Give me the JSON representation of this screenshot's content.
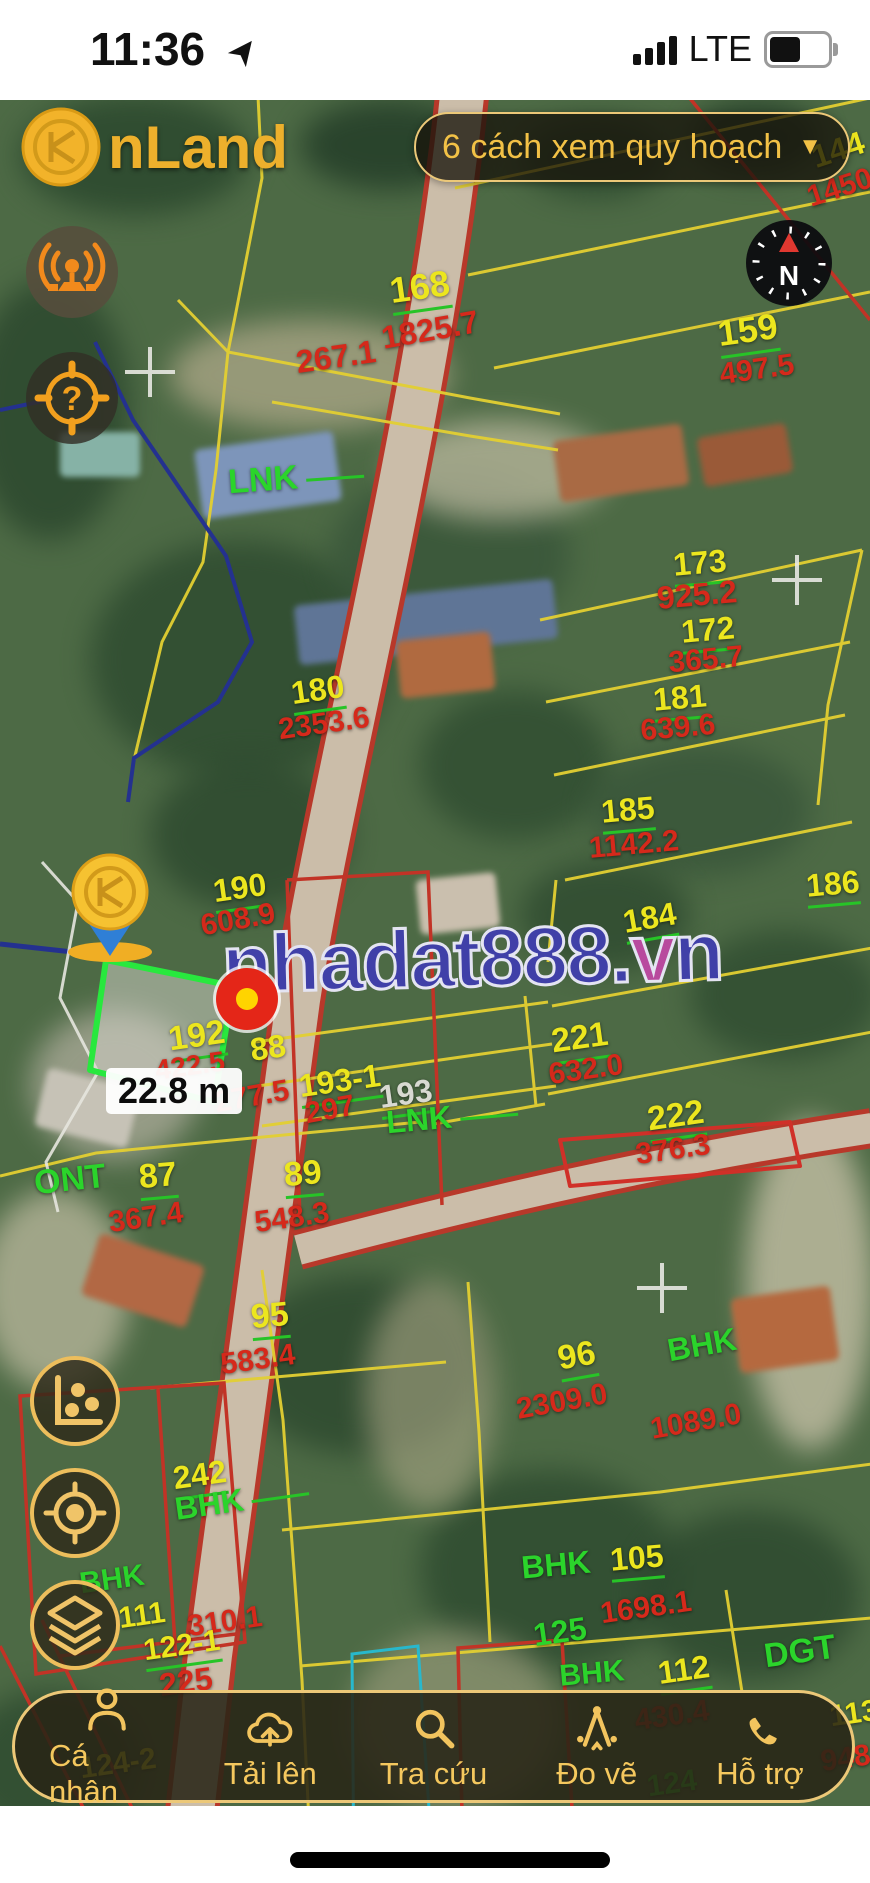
{
  "status_bar": {
    "time": "11:36",
    "network": "LTE"
  },
  "header": {
    "app_name": "nLand",
    "planning_selector": "6 cách xem quy hoạch",
    "dropdown_arrow": "▼"
  },
  "map_controls": {
    "compass_label": "N",
    "left_top_buttons": [
      "broadcast",
      "help-locate"
    ],
    "left_bottom_buttons": [
      "stats",
      "locate",
      "layers"
    ]
  },
  "map": {
    "watermark": "nhadat888.vn",
    "measurement_label": "22.8 m",
    "labels": [
      {
        "t": "168",
        "c": "num",
        "x": 420,
        "y": 289,
        "r": -8,
        "s": 36,
        "ul": 1
      },
      {
        "t": "1825.7",
        "c": "area",
        "x": 430,
        "y": 330,
        "r": -10,
        "s": 32
      },
      {
        "t": "159",
        "c": "num",
        "x": 748,
        "y": 332,
        "r": -8,
        "s": 36,
        "ul": 1
      },
      {
        "t": "497.5",
        "c": "area",
        "x": 757,
        "y": 370,
        "r": -8,
        "s": 30
      },
      {
        "t": "144",
        "c": "num",
        "x": 838,
        "y": 150,
        "r": -18,
        "s": 32
      },
      {
        "t": "1450",
        "c": "area",
        "x": 840,
        "y": 188,
        "r": -18,
        "s": 30
      },
      {
        "t": "267.1",
        "c": "area",
        "x": 336,
        "y": 357,
        "r": -8,
        "s": 32
      },
      {
        "t": "LNK",
        "c": "code",
        "x": 296,
        "y": 478,
        "r": -4,
        "s": 34,
        "line": 1
      },
      {
        "t": "173",
        "c": "num",
        "x": 700,
        "y": 565,
        "r": -5,
        "s": 32,
        "ul": 1
      },
      {
        "t": "925.2",
        "c": "area",
        "x": 697,
        "y": 595,
        "r": -5,
        "s": 32
      },
      {
        "t": "172",
        "c": "num",
        "x": 708,
        "y": 632,
        "r": -5,
        "s": 32,
        "ul": 1
      },
      {
        "t": "365.7",
        "c": "area",
        "x": 706,
        "y": 660,
        "r": -5,
        "s": 30
      },
      {
        "t": "180",
        "c": "num",
        "x": 318,
        "y": 692,
        "r": -8,
        "s": 32,
        "ul": 1
      },
      {
        "t": "2353.6",
        "c": "area",
        "x": 324,
        "y": 724,
        "r": -8,
        "s": 30
      },
      {
        "t": "181",
        "c": "num",
        "x": 680,
        "y": 700,
        "r": -5,
        "s": 32,
        "ul": 1
      },
      {
        "t": "639.6",
        "c": "area",
        "x": 678,
        "y": 728,
        "r": -5,
        "s": 30
      },
      {
        "t": "185",
        "c": "num",
        "x": 628,
        "y": 812,
        "r": -5,
        "s": 32,
        "ul": 1
      },
      {
        "t": "1142.2",
        "c": "area",
        "x": 634,
        "y": 845,
        "r": -5,
        "s": 30
      },
      {
        "t": "186",
        "c": "num",
        "x": 833,
        "y": 886,
        "r": -5,
        "s": 32,
        "ul": 1
      },
      {
        "t": "190",
        "c": "num",
        "x": 240,
        "y": 890,
        "r": -8,
        "s": 32,
        "ul": 1
      },
      {
        "t": "608.9",
        "c": "area",
        "x": 238,
        "y": 920,
        "r": -10,
        "s": 30
      },
      {
        "t": "184",
        "c": "num",
        "x": 650,
        "y": 920,
        "r": -10,
        "s": 32,
        "ul": 1
      },
      {
        "t": "192",
        "c": "num",
        "x": 197,
        "y": 1038,
        "r": -8,
        "s": 34,
        "ul": 1
      },
      {
        "t": "422.5",
        "c": "area",
        "x": 190,
        "y": 1066,
        "r": -8,
        "s": 28
      },
      {
        "t": "88",
        "c": "num",
        "x": 268,
        "y": 1048,
        "r": -8,
        "s": 32
      },
      {
        "t": "277.5",
        "c": "area",
        "x": 252,
        "y": 1097,
        "r": -10,
        "s": 30
      },
      {
        "t": "193-1",
        "c": "num",
        "x": 340,
        "y": 1083,
        "r": -8,
        "s": 32,
        "ul": 1
      },
      {
        "t": "297",
        "c": "area",
        "x": 330,
        "y": 1110,
        "r": -10,
        "s": 30
      },
      {
        "t": "193",
        "c": "plain",
        "x": 406,
        "y": 1096,
        "r": -8,
        "s": 32,
        "ul": 1
      },
      {
        "t": "LNK",
        "c": "code",
        "x": 452,
        "y": 1117,
        "r": -5,
        "s": 32,
        "line": 1
      },
      {
        "t": "221",
        "c": "num",
        "x": 580,
        "y": 1040,
        "r": -8,
        "s": 34,
        "ul": 1
      },
      {
        "t": "632.0",
        "c": "area",
        "x": 586,
        "y": 1070,
        "r": -8,
        "s": 30
      },
      {
        "t": "222",
        "c": "num",
        "x": 676,
        "y": 1118,
        "r": -8,
        "s": 34,
        "ul": 1
      },
      {
        "t": "376.3",
        "c": "area",
        "x": 673,
        "y": 1150,
        "r": -8,
        "s": 30
      },
      {
        "t": "ONT",
        "c": "code",
        "x": 70,
        "y": 1180,
        "r": -6,
        "s": 34
      },
      {
        "t": "87",
        "c": "num",
        "x": 158,
        "y": 1178,
        "r": -5,
        "s": 34,
        "ul": 1
      },
      {
        "t": "367.4",
        "c": "area",
        "x": 146,
        "y": 1218,
        "r": -8,
        "s": 30
      },
      {
        "t": "89",
        "c": "num",
        "x": 303,
        "y": 1176,
        "r": -5,
        "s": 34,
        "ul": 1
      },
      {
        "t": "548.3",
        "c": "area",
        "x": 292,
        "y": 1218,
        "r": -8,
        "s": 30
      },
      {
        "t": "95",
        "c": "num",
        "x": 270,
        "y": 1318,
        "r": -5,
        "s": 34,
        "ul": 1
      },
      {
        "t": "583.4",
        "c": "area",
        "x": 258,
        "y": 1360,
        "r": -8,
        "s": 30
      },
      {
        "t": "96",
        "c": "num",
        "x": 577,
        "y": 1358,
        "r": -10,
        "s": 34,
        "ul": 1
      },
      {
        "t": "2309.0",
        "c": "area",
        "x": 562,
        "y": 1402,
        "r": -10,
        "s": 30
      },
      {
        "t": "BHK",
        "c": "code",
        "x": 702,
        "y": 1345,
        "r": -10,
        "s": 32
      },
      {
        "t": "1089.0",
        "c": "area",
        "x": 696,
        "y": 1422,
        "r": -10,
        "s": 30
      },
      {
        "t": "242",
        "c": "num",
        "x": 200,
        "y": 1477,
        "r": -8,
        "s": 32,
        "ul": 1
      },
      {
        "t": "BHK",
        "c": "code",
        "x": 242,
        "y": 1500,
        "r": -8,
        "s": 32,
        "line": 1
      },
      {
        "t": "BHK",
        "c": "code",
        "x": 112,
        "y": 1580,
        "r": -8,
        "s": 30
      },
      {
        "t": "111",
        "c": "num",
        "x": 142,
        "y": 1616,
        "r": -8,
        "s": 30
      },
      {
        "t": "310.1",
        "c": "area",
        "x": 225,
        "y": 1622,
        "r": -8,
        "s": 30
      },
      {
        "t": "122-1",
        "c": "num",
        "x": 182,
        "y": 1648,
        "r": -8,
        "s": 30,
        "ul": 1
      },
      {
        "t": "225",
        "c": "area",
        "x": 186,
        "y": 1682,
        "r": -8,
        "s": 32
      },
      {
        "t": "BHK",
        "c": "code",
        "x": 556,
        "y": 1565,
        "r": -5,
        "s": 32
      },
      {
        "t": "105",
        "c": "num",
        "x": 637,
        "y": 1560,
        "r": -5,
        "s": 32,
        "ul": 1
      },
      {
        "t": "1698.1",
        "c": "area",
        "x": 646,
        "y": 1608,
        "r": -8,
        "s": 30
      },
      {
        "t": "125",
        "c": "code",
        "x": 560,
        "y": 1632,
        "r": -8,
        "s": 32
      },
      {
        "t": "DGT",
        "c": "code",
        "x": 800,
        "y": 1652,
        "r": -8,
        "s": 34
      },
      {
        "t": "BHK",
        "c": "code",
        "x": 592,
        "y": 1674,
        "r": -5,
        "s": 30
      },
      {
        "t": "112",
        "c": "num",
        "x": 684,
        "y": 1672,
        "r": -8,
        "s": 32,
        "ul": 1
      },
      {
        "t": "430.4",
        "c": "area",
        "x": 672,
        "y": 1716,
        "r": -8,
        "s": 30
      },
      {
        "t": "113",
        "c": "num",
        "x": 854,
        "y": 1714,
        "r": -8,
        "s": 30
      },
      {
        "t": "948.6",
        "c": "area",
        "x": 858,
        "y": 1757,
        "r": -8,
        "s": 30
      },
      {
        "t": "124",
        "c": "code",
        "x": 672,
        "y": 1784,
        "r": -8,
        "s": 30
      },
      {
        "t": "124-2",
        "c": "num",
        "x": 118,
        "y": 1764,
        "r": -8,
        "s": 30
      }
    ]
  },
  "bottom_nav": {
    "items": [
      {
        "label": "Cá nhân",
        "icon": "person-icon"
      },
      {
        "label": "Tải lên",
        "icon": "cloud-upload-icon"
      },
      {
        "label": "Tra cứu",
        "icon": "search-icon"
      },
      {
        "label": "Đo vẽ",
        "icon": "measure-icon"
      },
      {
        "label": "Hỗ trợ",
        "icon": "phone-icon"
      }
    ]
  },
  "colors": {
    "accent_gold": "#edb02c",
    "parcel_number": "#ece61e",
    "parcel_area": "#d5291b",
    "land_code": "#2bd42b",
    "highlight_parcel": "#28e83e",
    "watermark_blue": "#4040a8"
  }
}
